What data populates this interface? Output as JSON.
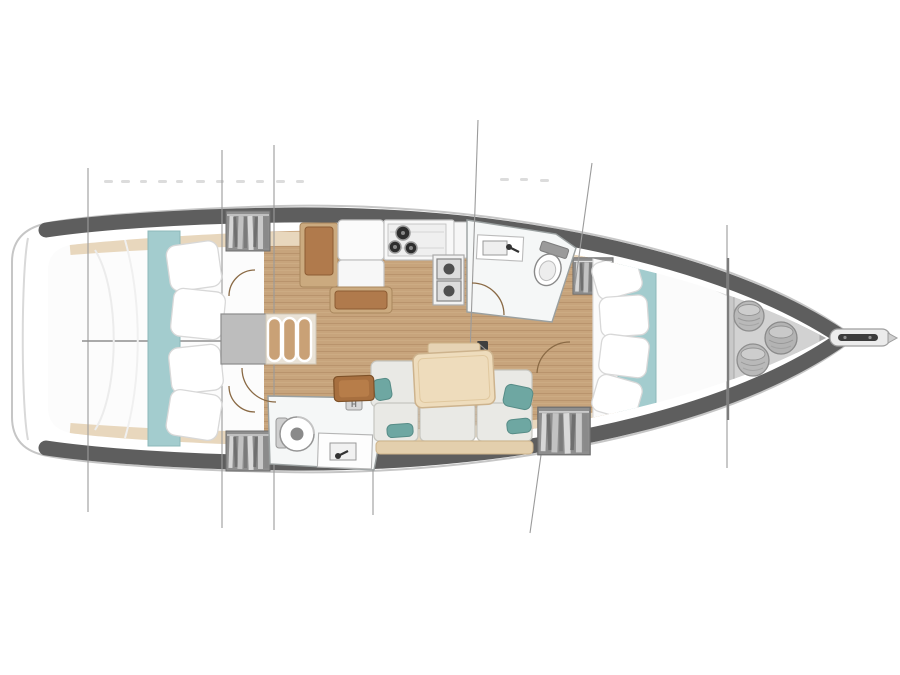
{
  "meta": {
    "title": "Sailing yacht interior floor plan (overhead view)",
    "orientation": "bow right, stern left",
    "style": "architectural deck plan with station lines"
  },
  "palette": {
    "background": "#ffffff",
    "hull_outline": "#c6c6c6",
    "bulwark_band": "#5e5e5e",
    "interior_white": "#fcfcfc",
    "wood_floor": "#c7a47c",
    "wood_grain": "#b8926b",
    "trim_shelf": "#e8d7bd",
    "teal_runner": "#a3ccce",
    "teal_pillow": "#6ea7a2",
    "sofa_cushion": "#e9e9e5",
    "table_wood": "#eedcbc",
    "bench_wood": "#b07a4c",
    "bench_frame": "#cbaa7f",
    "locker_gray": "#c9c9c9",
    "wardrobe_gray": "#8e8e8e",
    "fixture_white": "#f5f7f7",
    "station_line": "#9b9b9b",
    "door_arc": "#8a6a45",
    "dark_fitting": "#3f3f3f"
  },
  "rooms": [
    {
      "id": "aft-cabin-port",
      "label": "Aft double cabin (port)"
    },
    {
      "id": "aft-cabin-starboard",
      "label": "Aft double cabin (starboard)"
    },
    {
      "id": "galley",
      "label": "Galley: 3-burner stove, twin sinks, bench"
    },
    {
      "id": "head-forward",
      "label": "Forward head: toilet and washbasin"
    },
    {
      "id": "head-aft",
      "label": "Aft head: toilet and washbasin"
    },
    {
      "id": "salon",
      "label": "Salon: sofa with dining table"
    },
    {
      "id": "forward-cabin",
      "label": "Forward V-berth cabin"
    },
    {
      "id": "anchor-locker",
      "label": "Bow anchor / sail locker"
    },
    {
      "id": "companionway",
      "label": "Companionway steps"
    }
  ],
  "badges": {
    "heater": "H"
  },
  "counts": {
    "berth_areas": 3,
    "heads": 2,
    "hanging_lockers": 4,
    "stove_burners": 3,
    "sinks": 2,
    "companionway_steps": 3,
    "rope_coils": 3,
    "station_lines": 7
  }
}
